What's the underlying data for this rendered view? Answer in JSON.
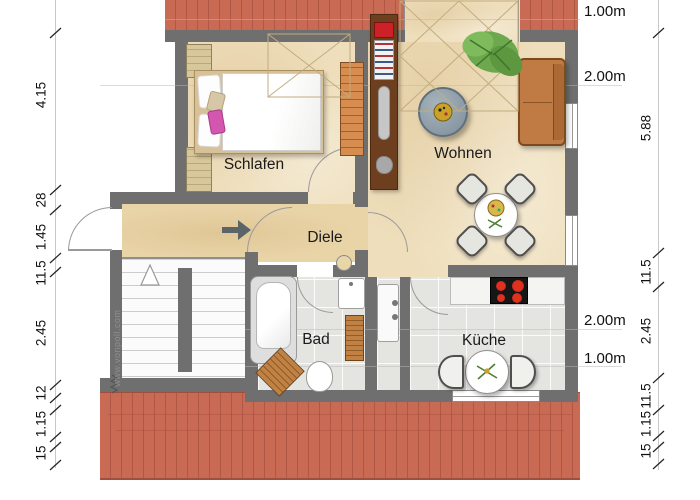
{
  "rooms": {
    "schlafen": "Schlafen",
    "wohnen": "Wohnen",
    "diele": "Diele",
    "bad": "Bad",
    "kueche": "Küche"
  },
  "dimensions": {
    "left": [
      "4.15",
      "28",
      "1.45",
      "11.5",
      "2.45",
      "12",
      "1.15",
      "15"
    ],
    "right": [
      "5.88",
      "11.5",
      "2.45",
      "11.5",
      "1.15",
      "15"
    ],
    "height_lines": [
      "1.00m",
      "2.00m",
      "2.00m",
      "1.00m"
    ]
  },
  "watermark": "www.vonpoll.com",
  "colors": {
    "roof": "#c96a54",
    "wall": "#6f6f6f",
    "floor_living": "#eedebb",
    "floor_hall": "#e9d4a8",
    "floor_wet": "#e4e4e1",
    "sofa_orange": "#c07a43",
    "pillow_pink": "#d357ae",
    "plant_green": "#6da84e",
    "burner_red": "#cf2b1c",
    "coffee_table": "#8f9ea8",
    "wood": "#b97c3e"
  }
}
